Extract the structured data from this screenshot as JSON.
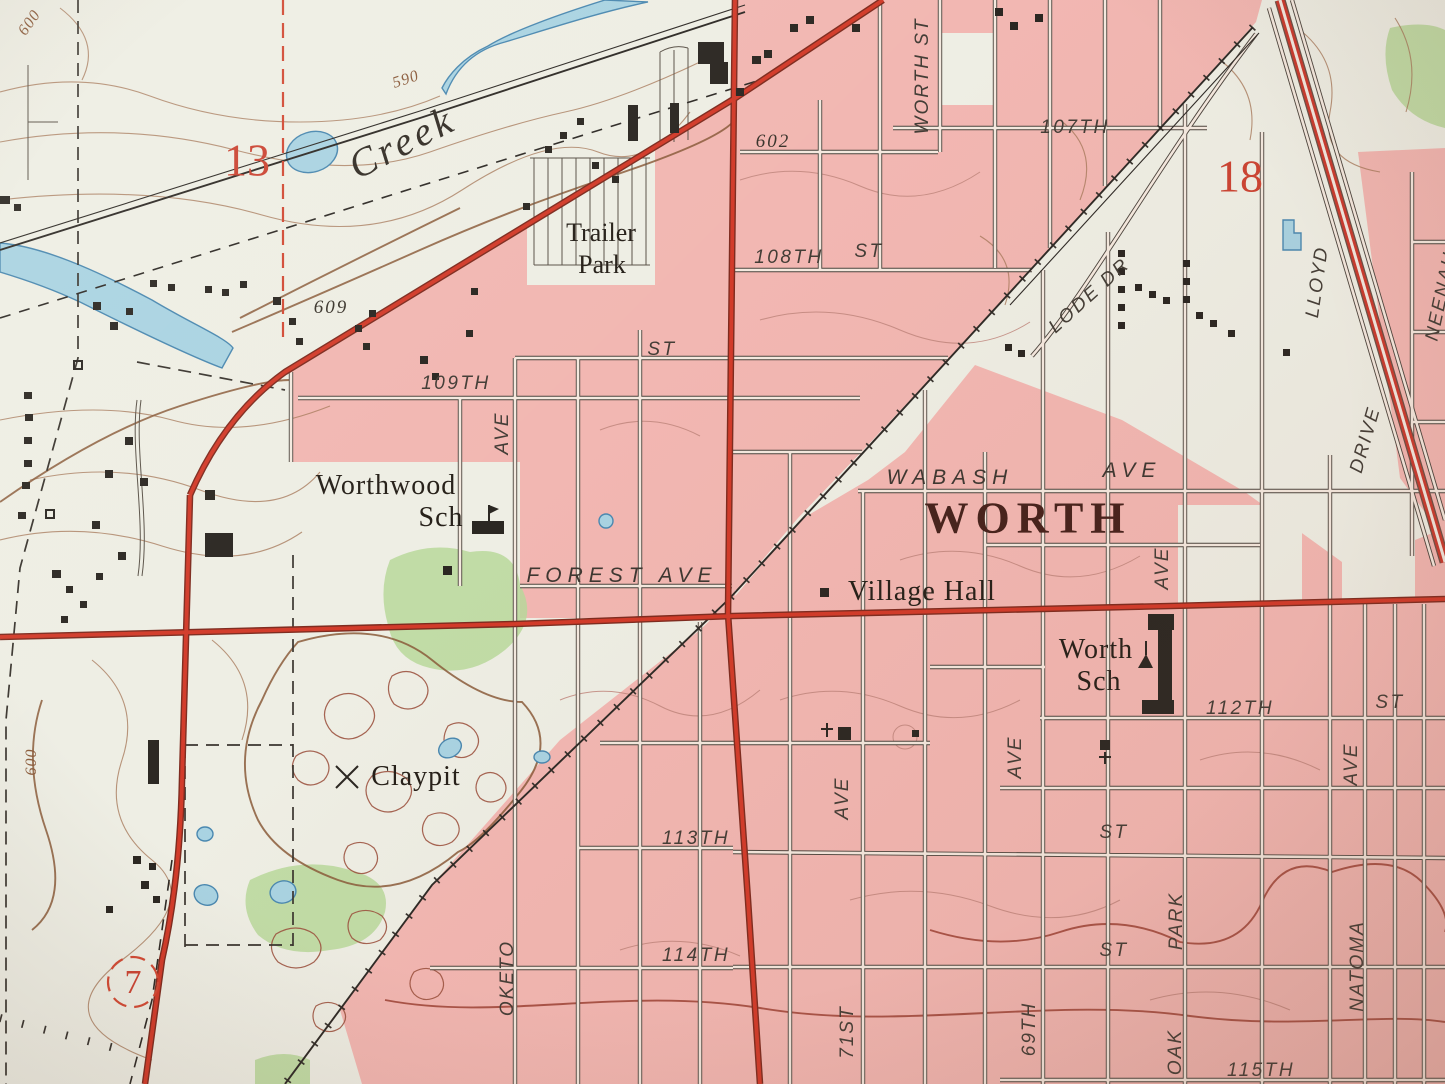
{
  "map": {
    "kind": "USGS topographic quadrangle map (photographed detail)",
    "town": "WORTH",
    "section_numbers": [
      "13",
      "18"
    ],
    "route_marker": "7",
    "contour_elevations": [
      "600",
      "590",
      "609",
      "602",
      "600"
    ],
    "symbols": {
      "school-flag-icon": "pennant on pole at school buildings",
      "church-icon": "black square with cross",
      "mine-icon": "crossed picks at Claypit",
      "building-icon": "small black squares",
      "railroad-icon": "line with cross ties",
      "highway-icon": "double red line",
      "section-line-icon": "dashed red line"
    }
  },
  "colors": {
    "paper": "#eeeee4",
    "urban_pink": "#f2b7b2",
    "woodland_green": "#b9d89b",
    "water_blue": "#a9d3e2",
    "water_outline": "#4a88b0",
    "road_red": "#d23b2a",
    "ink_black": "#2b2722",
    "contour_brown": "#a87a5c",
    "red_numbers": "#cb4433"
  },
  "labels": [
    {
      "id": "contour-600-top",
      "t": "600",
      "x": 30,
      "y": 23,
      "r": -55,
      "c": "contour"
    },
    {
      "id": "contour-590",
      "t": "590",
      "x": 406,
      "y": 80,
      "r": -18,
      "c": "contour"
    },
    {
      "id": "creek-name",
      "t": "Creek",
      "x": 402,
      "y": 142,
      "r": -27,
      "c": "creek"
    },
    {
      "id": "section-13",
      "t": "13",
      "x": 247,
      "y": 160,
      "r": 0,
      "c": "rednum"
    },
    {
      "id": "spot-609",
      "t": "609",
      "x": 331,
      "y": 308,
      "r": 0,
      "c": "spot"
    },
    {
      "id": "spot-602",
      "t": "602",
      "x": 773,
      "y": 142,
      "r": 0,
      "c": "spot"
    },
    {
      "id": "trailer-park-1",
      "t": "Trailer",
      "x": 601,
      "y": 233,
      "r": 0,
      "c": "name26"
    },
    {
      "id": "trailer-park-2",
      "t": "Park",
      "x": 602,
      "y": 265,
      "r": 0,
      "c": "name26"
    },
    {
      "id": "st-108th",
      "t": "108TH",
      "x": 789,
      "y": 258,
      "r": 0,
      "c": "st"
    },
    {
      "id": "st-108th-st",
      "t": "ST",
      "x": 869,
      "y": 252,
      "r": 0,
      "c": "st"
    },
    {
      "id": "st-worth-st",
      "t": "WORTH ST",
      "x": 923,
      "y": 76,
      "r": -90,
      "c": "stv"
    },
    {
      "id": "st-107th",
      "t": "107TH",
      "x": 1075,
      "y": 128,
      "r": 0,
      "c": "st"
    },
    {
      "id": "section-18",
      "t": "18",
      "x": 1240,
      "y": 176,
      "r": 0,
      "c": "rednum"
    },
    {
      "id": "st-lode-dr",
      "t": "LODE DR",
      "x": 1090,
      "y": 296,
      "r": -42,
      "c": "st"
    },
    {
      "id": "st-lloyd",
      "t": "LLOYD",
      "x": 1318,
      "y": 282,
      "r": -82,
      "c": "stv"
    },
    {
      "id": "st-lloyd-drive",
      "t": "DRIVE",
      "x": 1366,
      "y": 440,
      "r": -74,
      "c": "stv"
    },
    {
      "id": "st-neenah",
      "t": "NEENAH AVE",
      "x": 1447,
      "y": 272,
      "r": -78,
      "c": "stv"
    },
    {
      "id": "st-109th",
      "t": "109TH",
      "x": 456,
      "y": 384,
      "r": 0,
      "c": "st"
    },
    {
      "id": "st-109th-st",
      "t": "ST",
      "x": 662,
      "y": 350,
      "r": 0,
      "c": "st"
    },
    {
      "id": "ave-oketo-n",
      "t": "AVE",
      "x": 503,
      "y": 433,
      "r": -90,
      "c": "stv"
    },
    {
      "id": "worthwood-sch-1",
      "t": "Worthwood",
      "x": 386,
      "y": 486,
      "r": 0,
      "c": "name30"
    },
    {
      "id": "worthwood-sch-2",
      "t": "Sch",
      "x": 441,
      "y": 518,
      "r": 0,
      "c": "name30"
    },
    {
      "id": "st-forest-ave",
      "t": "FOREST AVE",
      "x": 622,
      "y": 576,
      "r": 0,
      "c": "st24"
    },
    {
      "id": "st-wabash",
      "t": "WABASH",
      "x": 950,
      "y": 478,
      "r": 0,
      "c": "st24"
    },
    {
      "id": "st-wabash-ave",
      "t": "AVE",
      "x": 1132,
      "y": 471,
      "r": 0,
      "c": "st24"
    },
    {
      "id": "town-worth",
      "t": "WORTH",
      "x": 1028,
      "y": 518,
      "r": 0,
      "c": "town"
    },
    {
      "id": "village-hall",
      "t": "Village Hall",
      "x": 922,
      "y": 592,
      "r": 0,
      "c": "name30"
    },
    {
      "id": "worth-sch-1",
      "t": "Worth",
      "x": 1096,
      "y": 650,
      "r": 0,
      "c": "name30"
    },
    {
      "id": "worth-sch-2",
      "t": "Sch",
      "x": 1099,
      "y": 682,
      "r": 0,
      "c": "name30"
    },
    {
      "id": "st-112th",
      "t": "112TH",
      "x": 1240,
      "y": 709,
      "r": 0,
      "c": "st"
    },
    {
      "id": "st-112th-st",
      "t": "ST",
      "x": 1390,
      "y": 703,
      "r": 0,
      "c": "st"
    },
    {
      "id": "ave-home",
      "t": "AVE",
      "x": 1163,
      "y": 568,
      "r": -90,
      "c": "stv"
    },
    {
      "id": "ave-69th-n",
      "t": "AVE",
      "x": 1016,
      "y": 757,
      "r": -90,
      "c": "stv"
    },
    {
      "id": "ave-71st-n",
      "t": "AVE",
      "x": 843,
      "y": 798,
      "r": -90,
      "c": "stv"
    },
    {
      "id": "ave-natoma-n",
      "t": "AVE",
      "x": 1352,
      "y": 764,
      "r": -90,
      "c": "stv"
    },
    {
      "id": "st-113th",
      "t": "113TH",
      "x": 696,
      "y": 839,
      "r": 0,
      "c": "st"
    },
    {
      "id": "st-113th-st",
      "t": "ST",
      "x": 1114,
      "y": 833,
      "r": 0,
      "c": "st"
    },
    {
      "id": "ave-oketo",
      "t": "OKETO",
      "x": 508,
      "y": 978,
      "r": -90,
      "c": "stv"
    },
    {
      "id": "st-114th",
      "t": "114TH",
      "x": 696,
      "y": 956,
      "r": 0,
      "c": "st"
    },
    {
      "id": "st-114th-st",
      "t": "ST",
      "x": 1114,
      "y": 951,
      "r": 0,
      "c": "st"
    },
    {
      "id": "ave-71st",
      "t": "71ST",
      "x": 848,
      "y": 1032,
      "r": -90,
      "c": "stv"
    },
    {
      "id": "ave-69th",
      "t": "69TH",
      "x": 1030,
      "y": 1029,
      "r": -90,
      "c": "stv"
    },
    {
      "id": "ave-oak-park-2",
      "t": "PARK",
      "x": 1177,
      "y": 921,
      "r": -90,
      "c": "stv"
    },
    {
      "id": "ave-oak-park-1",
      "t": "OAK",
      "x": 1176,
      "y": 1052,
      "r": -90,
      "c": "stv"
    },
    {
      "id": "ave-natoma",
      "t": "NATOMA",
      "x": 1358,
      "y": 966,
      "r": -90,
      "c": "stv"
    },
    {
      "id": "st-115th",
      "t": "115TH",
      "x": 1261,
      "y": 1071,
      "r": 0,
      "c": "st"
    },
    {
      "id": "claypit",
      "t": "Claypit",
      "x": 416,
      "y": 777,
      "r": 0,
      "c": "name30"
    },
    {
      "id": "route-7",
      "t": "7",
      "x": 133,
      "y": 983,
      "r": 0,
      "c": "rednum7"
    },
    {
      "id": "contour-600-left",
      "t": "600",
      "x": 32,
      "y": 762,
      "r": -90,
      "c": "contour"
    }
  ]
}
